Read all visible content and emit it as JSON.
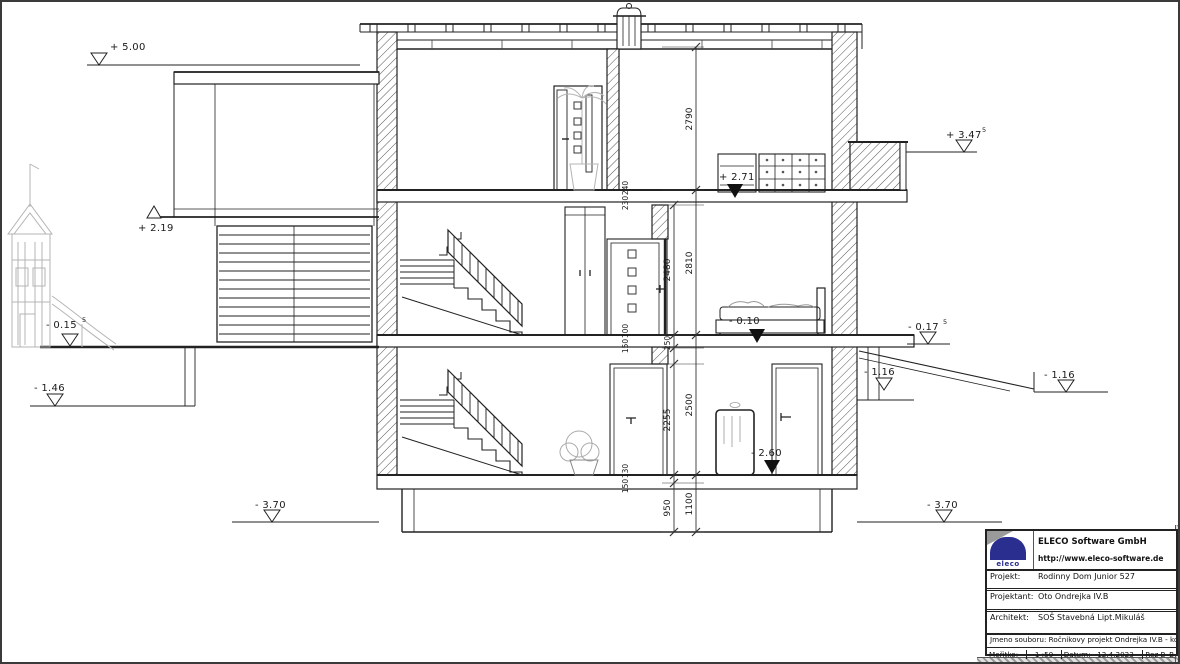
{
  "drawing": {
    "type": "architectural-section",
    "section_name": "Rez B–B",
    "scale": "1 :50"
  },
  "elevations": {
    "roof_left": "+ 5.00",
    "annex_roof": "+ 2.19",
    "grade_left": "- 0.15",
    "grade_left_sup": "5",
    "grade_left_lower": "- 1.46",
    "footing_left": "- 3.70",
    "balcony_right": "+ 3.47",
    "balcony_right_sup": "5",
    "grade_right": "- 0.17",
    "grade_right_sup": "5",
    "terrace_right_near": "- 1.16",
    "terrace_right_far": "- 1.16",
    "footing_right": "- 3.70",
    "floor_top_interior": "+ 2.71",
    "floor_mid_interior": "- 0.10",
    "floor_low_interior": "- 2.60"
  },
  "dimensions": {
    "top_storey": "2790",
    "top_junction_a": "240",
    "top_junction_b": "230",
    "mid_clear": "2480",
    "mid_storey": "2810",
    "mid_junction_a": "100",
    "mid_junction_b": "150",
    "mid_junction_c": "250",
    "low_clear": "2255",
    "low_storey": "2500",
    "low_junction_a": "130",
    "low_junction_b": "150",
    "foundation_a": "950",
    "foundation_b": "1100"
  },
  "title_block": {
    "logo_text": "eleco",
    "company": "ELECO Software GmbH",
    "website": "http://www.eleco-software.de",
    "project_label": "Projekt:",
    "project_value": "Rodinny Dom Junior 527",
    "designer_label": "Projektant:",
    "designer_value": "Oto Ondrejka IV.B",
    "architect_label": "Architekt:",
    "architect_value": "SOŠ Stavebná Lipt.Mikuláš",
    "file_label": "Jmeno souboru:",
    "file_value": "Ročnikovy projekt Ondrejka IV.B - kopia",
    "scale_label": "Meřitko:",
    "scale_value": "1 :50",
    "date_label": "Datum:",
    "date_value": "12.4.2023",
    "section_value": "Rez B–B"
  },
  "colors": {
    "line": "#222222",
    "art_gray": "#b4b4b4",
    "logo_blue": "#2a2f8f",
    "logo_gray": "#9a9a9a"
  }
}
